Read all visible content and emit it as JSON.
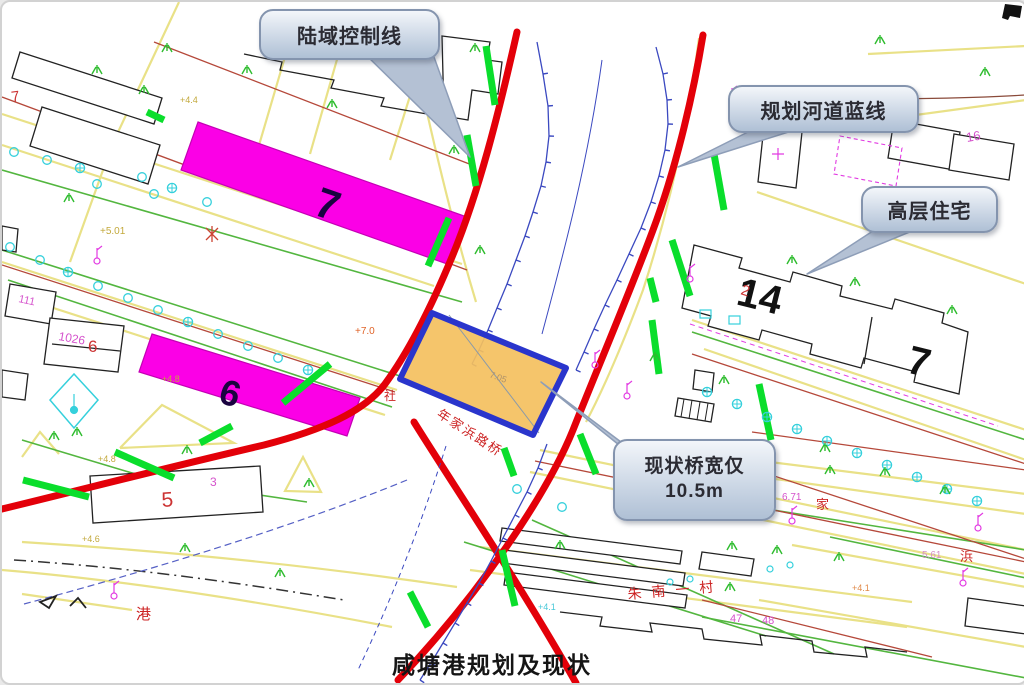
{
  "frame": {
    "title_caption": "咸塘港规划及现状"
  },
  "callouts": {
    "land_control": "陆域控制线",
    "river_blue": "规划河道蓝线",
    "highrise": "高层住宅",
    "bridge_line1": "现状桥宽仅",
    "bridge_line2": "10.5m"
  },
  "labels": {
    "bldg7_left": "7",
    "bldg6": "6",
    "bldg14": "14",
    "bldg7_right": "7",
    "bldg5": "5",
    "bldg16": "16",
    "bldg111": "111",
    "bldg1026": "1026",
    "red6": "6",
    "red7": "7",
    "red2": "2",
    "num3": "3",
    "num47": "47",
    "num48": "48",
    "village": "朱南一村",
    "bridge_road": "年家浜路桥",
    "char_she": "社",
    "char_gang": "港",
    "char_jia": "家",
    "char_bang": "浜",
    "elev_44": "+4.4",
    "elev_501": "+5.01",
    "elev_48a": "+4.8",
    "elev_48b": "+4.8",
    "elev_46": "+4.6",
    "elev_70": "+7.0",
    "elev_671": "6.71",
    "elev_561": "5.61",
    "elev_41a": "+4.1",
    "elev_41b": "+4.1",
    "elev_705": "7.05"
  },
  "colors": {
    "river_line_red": "#e30009",
    "control_line_green": "#0ade2c",
    "building_magenta": "#fb00e6",
    "bridge_fill_orange": "#f4c05e",
    "bridge_border_blue": "#2a35cc",
    "bank_blue": "#3b49c0",
    "road_yellow": "#e9e187",
    "tree_cyan": "#35d0dc",
    "callout_fill": "#c3cfe0"
  }
}
